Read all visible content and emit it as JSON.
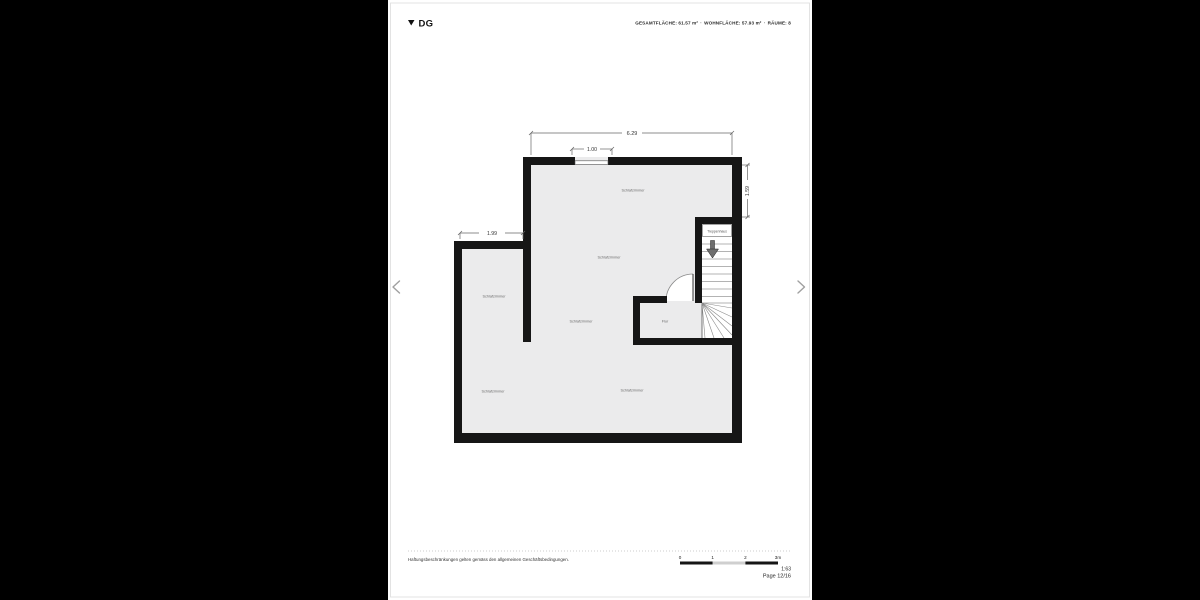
{
  "header": {
    "floor_label": "DG",
    "stats_segments": [
      "GESAMTFLÄCHE: 61.57 m²",
      "·",
      "WOHNFLÄCHE: 57.93 m²",
      "·",
      "RÄUME: 8"
    ]
  },
  "floorplan": {
    "dimensions": {
      "top_width": "6.29",
      "window_width": "1.00",
      "left_room_width": "1.99",
      "right_height": "1.59"
    },
    "room_labels": [
      {
        "id": "schlafzimmer-top",
        "label": "Schlafzimmer"
      },
      {
        "id": "schlafzimmer-middle",
        "label": "Schlafzimmer"
      },
      {
        "id": "schlafzimmer-left",
        "label": "Schlafzimmer"
      },
      {
        "id": "schlafzimmer-center",
        "label": "Schlafzimmer"
      },
      {
        "id": "flur",
        "label": "Flur"
      },
      {
        "id": "schlafzimmer-bottom-left",
        "label": "Schlafzimmer"
      },
      {
        "id": "schlafzimmer-bottom-center",
        "label": "Schlafzimmer"
      },
      {
        "id": "treppenhaus",
        "label": "Treppenhaus"
      }
    ]
  },
  "navigation": {
    "prev_icon": "chevron-left",
    "next_icon": "chevron-right"
  },
  "footer": {
    "disclaimer": "Haftungsbeschränkungen gelten gemäss den allgemeinen Geschäftsbedingungen.",
    "scale_ticks": [
      "0",
      "1",
      "2",
      "3m"
    ],
    "scale_ratio": "1:63",
    "page_indicator": "Page 12/16"
  },
  "colors": {
    "background": "#000000",
    "page": "#ffffff",
    "wall": "#161616",
    "room_fill": "#ebebec",
    "label_text": "#666666",
    "dimension_text": "#333333",
    "scale_bar_dark": "#151515",
    "scale_bar_light": "#cfcfcf"
  }
}
